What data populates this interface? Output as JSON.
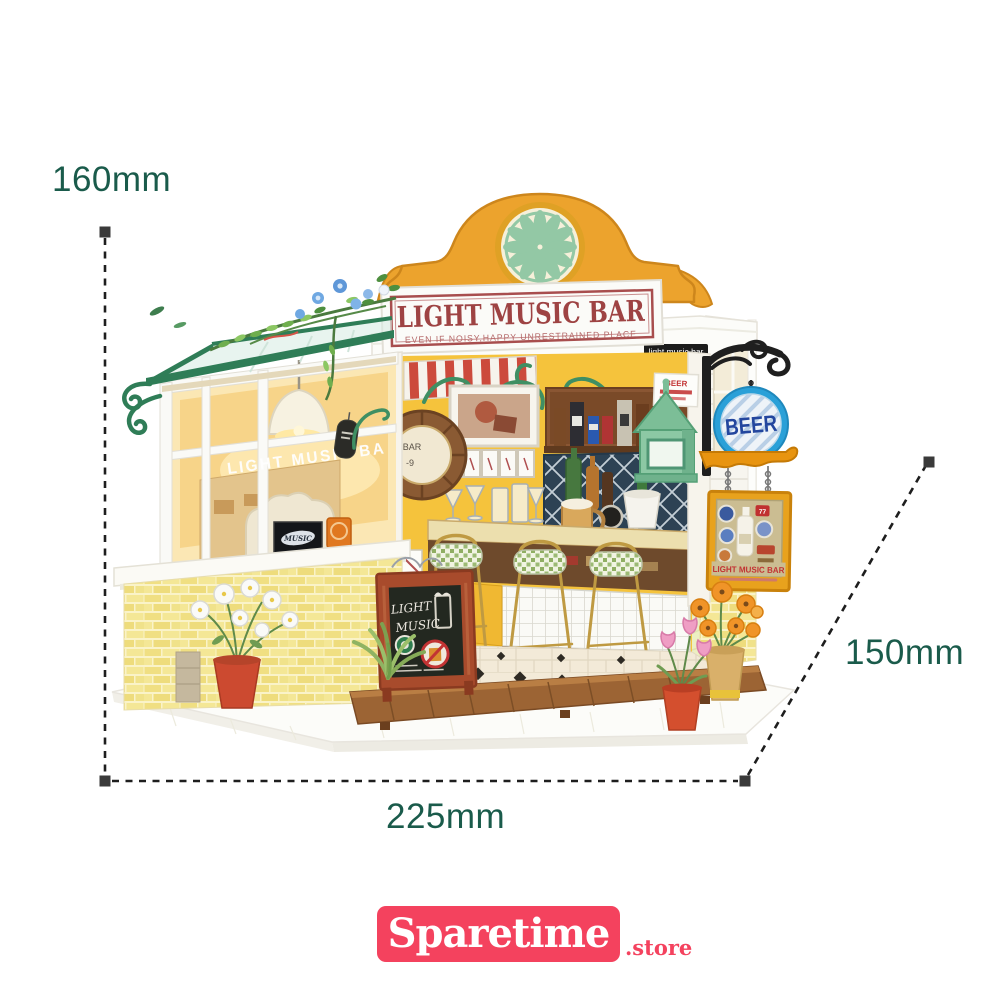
{
  "dimensions": {
    "height_label": "160mm",
    "width_label": "225mm",
    "depth_label": "150mm"
  },
  "branding": {
    "store_name": "Sparetime",
    "store_tld": ".store"
  },
  "signs": {
    "main_title": "LIGHT MUSIC BAR",
    "main_subtitle": "EVEN IF NOISY,HAPPY UNRESTRAINED PLACE",
    "fascia_label": "light music bar",
    "beer_round": "BEER",
    "mini_poster": "BEER",
    "glass_text": "LIGHT MUSIC BA",
    "clock_top": "BAR",
    "clock_bottom": "-9",
    "poster_music": "MUSIC",
    "poster_music_bar": "BAR",
    "poster_lightlight": "LIGHTLIGHT",
    "chalk_line1": "LIGHT",
    "chalk_line2": "MUSIC",
    "hanging_sign_title": "LIGHT MUSIC BAR",
    "badge_77": "77"
  },
  "colors": {
    "dimension_text": "#1a5b4b",
    "dimension_line": "#1e1e1e",
    "logo_pink": "#f4425e",
    "pediment_yellow": "#eca32d",
    "rosette_mint": "#93c8a5",
    "sign_text_red": "#9e4343",
    "awning_green": "#2f7d57",
    "brick_yellow": "#f0df82",
    "beer_sign_blue": "#2aa0d8",
    "beer_text_navy": "#23469e",
    "lantern_mint": "#8cc8a4",
    "hanging_sign_orange": "#e8a21d"
  }
}
